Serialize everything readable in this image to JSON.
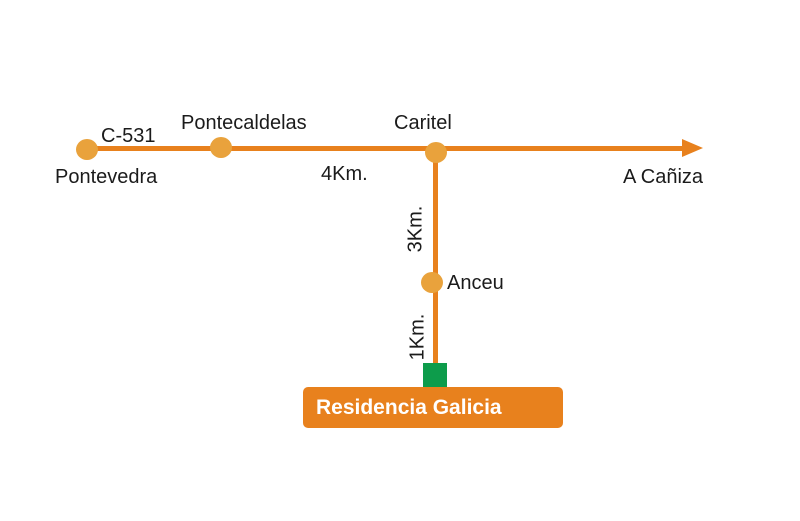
{
  "colors": {
    "road": "#e8811d",
    "node": "#e9a23c",
    "marker_green": "#0d9c4b",
    "label": "#1b1b1b",
    "banner_bg": "#e8811d",
    "banner_text": "#ffffff"
  },
  "route": {
    "road_code": "C-531",
    "stops": [
      {
        "name": "Pontevedra"
      },
      {
        "name": "Pontecaldelas"
      },
      {
        "name": "Caritel"
      },
      {
        "name": "Anceu"
      }
    ],
    "direction_label": "A Cañiza",
    "distances": {
      "pontecaldelas_to_caritel": "4Km.",
      "caritel_to_anceu": "3Km.",
      "anceu_to_residencia": "1Km."
    },
    "destination_banner": "Residencia Galicia"
  }
}
